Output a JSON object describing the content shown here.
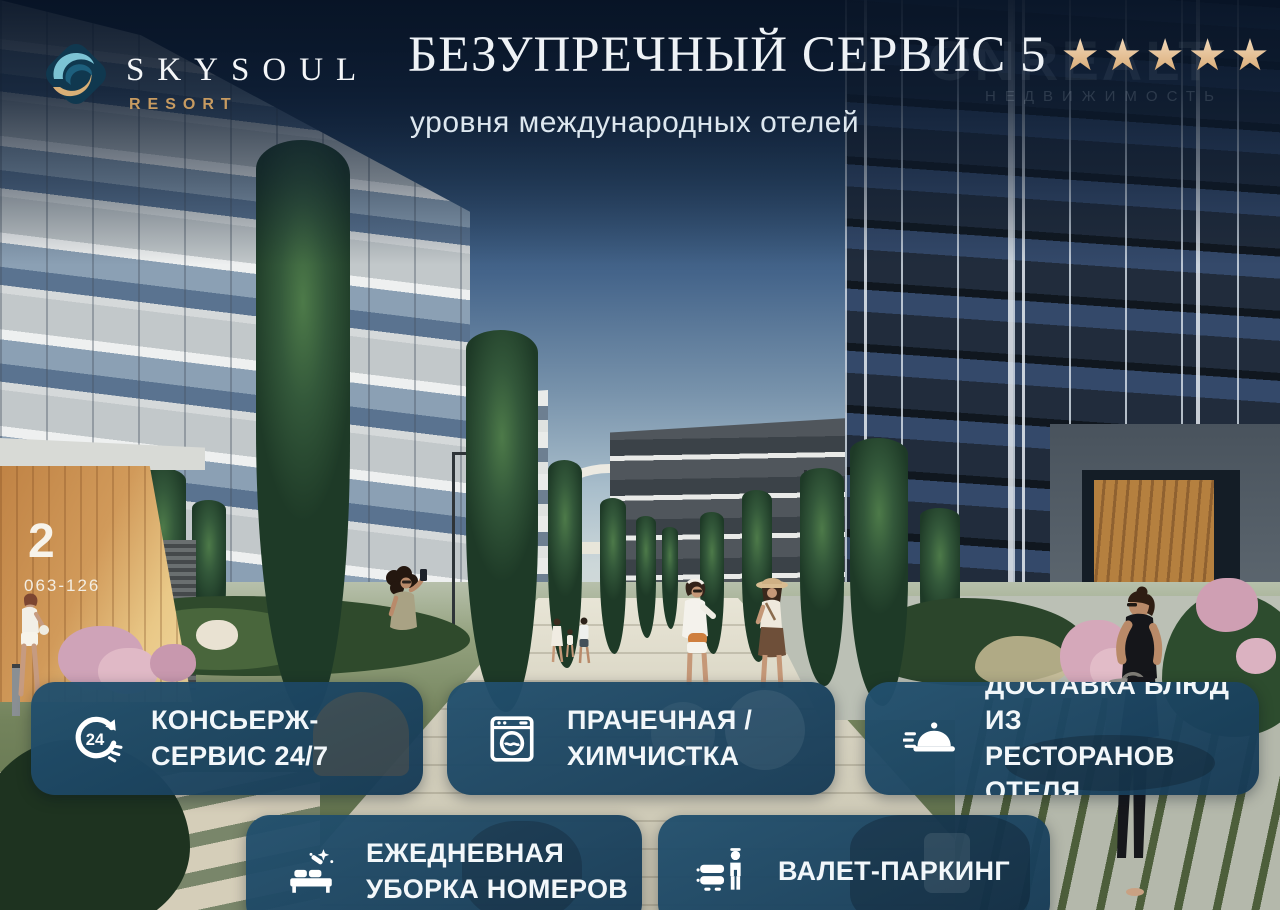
{
  "brand": {
    "name": "SKYSOUL",
    "subtitle": "RESORT"
  },
  "header": {
    "title": "БЕЗУПРЕЧНЫЙ СЕРВИС 5",
    "stars": "★★★★★",
    "subtitle": "уровня международных отелей"
  },
  "watermark": {
    "name": "ONREALT",
    "caption": "НЕДВИЖИМОСТЬ"
  },
  "building_sign": {
    "number": "2",
    "units": "063-126"
  },
  "cards": [
    {
      "icon": "24-7-concierge-icon",
      "lines": [
        "КОНСЬЕРЖ-",
        "СЕРВИС 24/7"
      ]
    },
    {
      "icon": "washing-machine-icon",
      "lines": [
        "ПРАЧЕЧНАЯ /",
        "ХИМЧИСТКА"
      ]
    },
    {
      "icon": "food-cloche-icon",
      "lines": [
        "ДОСТАВКА БЛЮД ИЗ",
        "РЕСТОРАНОВ ОТЕЛЯ"
      ]
    },
    {
      "icon": "bed-cleaning-icon",
      "lines": [
        "ЕЖЕДНЕВНАЯ",
        "УБОРКА НОМЕРОВ"
      ]
    },
    {
      "icon": "valet-parking-icon",
      "lines": [
        "ВАЛЕТ-ПАРКИНГ"
      ]
    }
  ],
  "colors": {
    "card_background": "#1d4b68",
    "star_gold": "#e6c493",
    "brand_gold": "#c79b61",
    "overlay_navy": "#0a1628"
  }
}
